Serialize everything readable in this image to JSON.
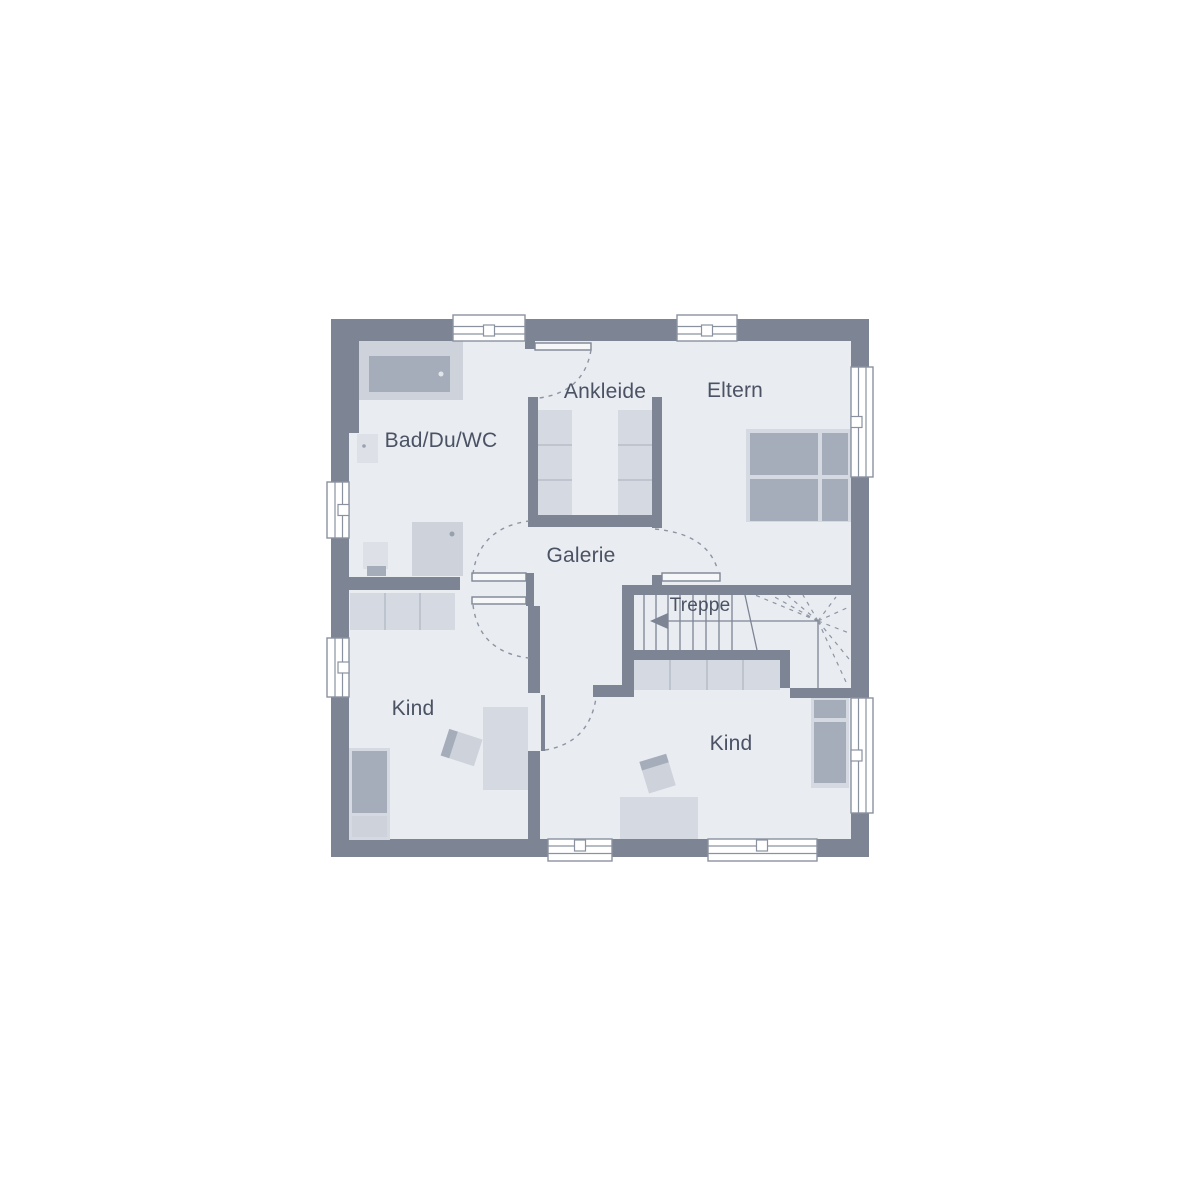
{
  "plan": {
    "type": "floor-plan",
    "floor_labels": {
      "bathroom": "Bad/Du/WC",
      "dressing": "Ankleide",
      "parents": "Eltern",
      "gallery": "Galerie",
      "stairs": "Treppe",
      "child_left": "Kind",
      "child_right": "Kind"
    },
    "colors": {
      "background": "#ffffff",
      "wall": "#7d8595",
      "floor": "#e9ecf1",
      "furniture_light": "#d5d9e1",
      "furniture_mid": "#cdd2db",
      "furniture_dark": "#a6adba",
      "fixture_pale": "#dde0e7",
      "thin_line": "#8a92a0",
      "label_text": "#4a5263"
    }
  }
}
